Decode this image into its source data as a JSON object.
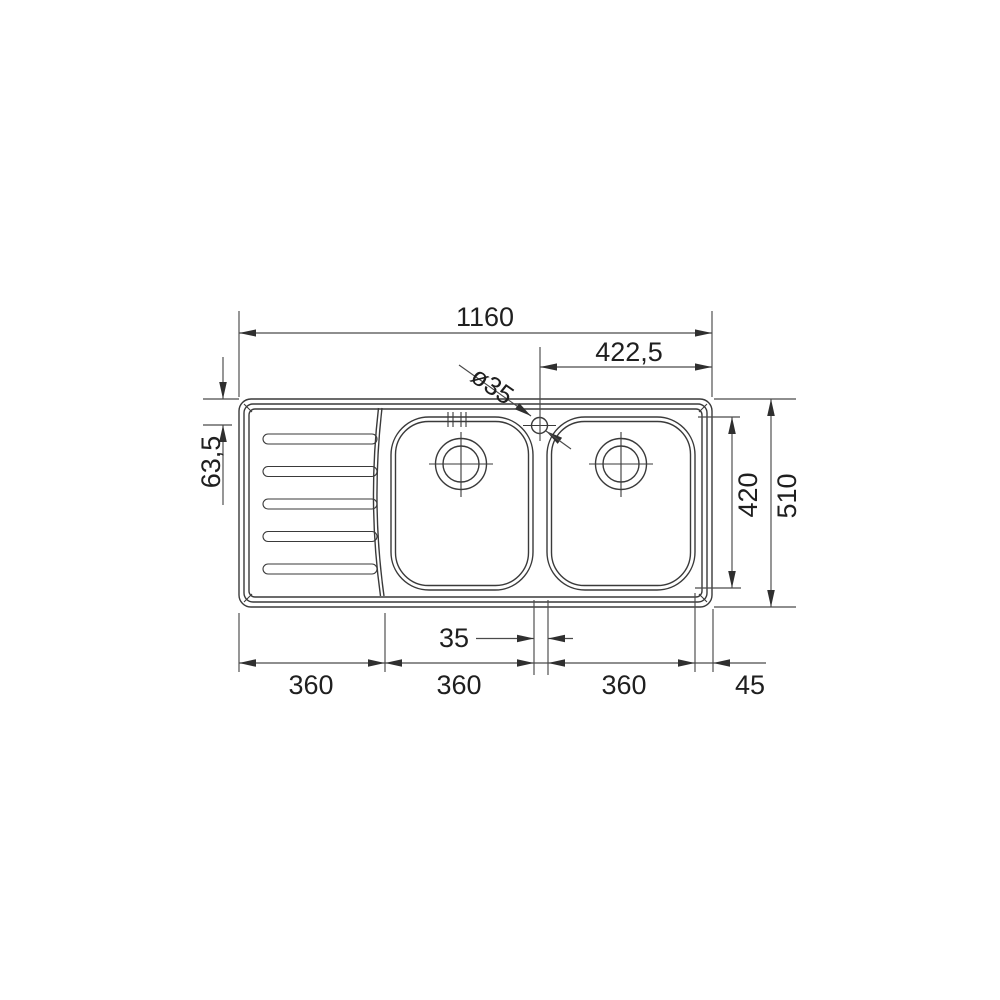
{
  "drawing": {
    "subject": "double-bowl kitchen sink with left drainboard, top view technical drawing",
    "background": "#ffffff",
    "line_color": "#3a3a3a",
    "text_color": "#1f1f1f",
    "labels": {
      "total_width": "1160",
      "tap_offset_right": "422,5",
      "tap_hole_diameter": "ø35",
      "edge_to_bowl_top": "63,5",
      "bowl_depth": "420",
      "total_depth": "510",
      "bowl_gap": "35",
      "drainer_width": "360",
      "left_bowl_width": "360",
      "right_bowl_width": "360",
      "right_margin": "45"
    }
  }
}
